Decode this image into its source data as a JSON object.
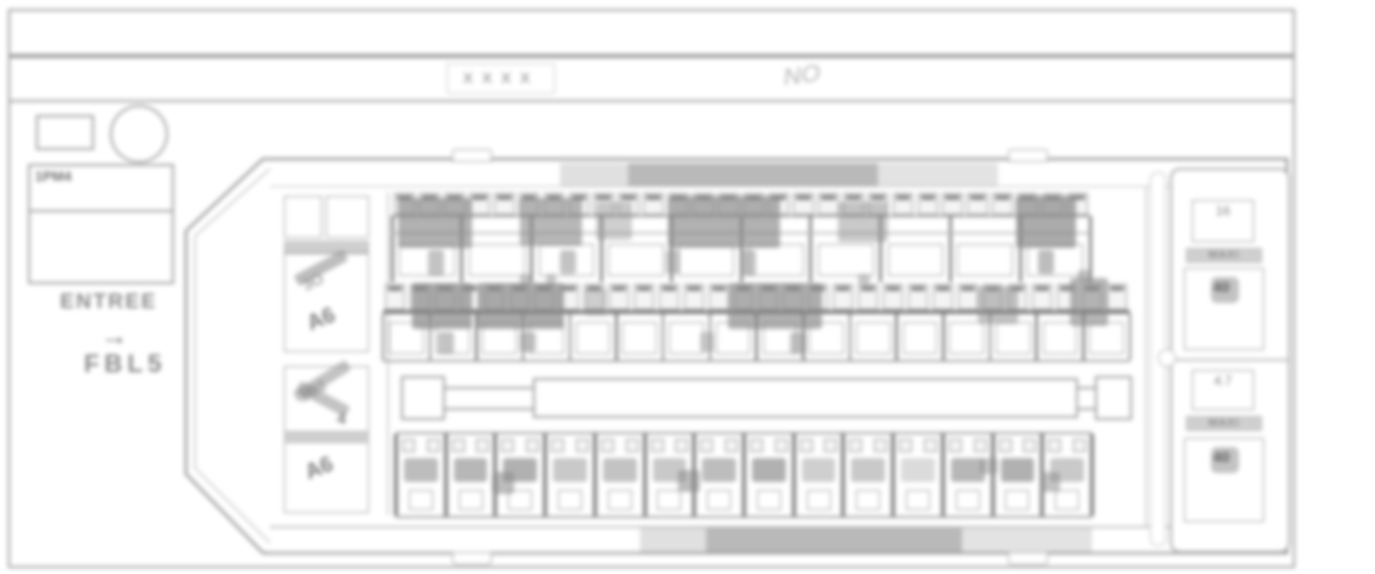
{
  "header": {
    "row1_text": "",
    "code_label": "XXXX",
    "approval_mark": "NO"
  },
  "left_panel": {
    "module_label": "1PM4",
    "entry_label": "ENTREE",
    "arrow_glyph": "→",
    "wire_label": "FBL5"
  },
  "relay_column": {
    "group1": {
      "band_text": "— —",
      "diag_text1": "3O",
      "tag": "A6"
    },
    "group2": {
      "band_text": "— —",
      "diag_text1": "1O2",
      "diag_text2": "4",
      "tag": "A6"
    }
  },
  "right_column": {
    "group1": {
      "value": "16",
      "type_label": "MAXI",
      "amp": "40"
    },
    "group2": {
      "value": "4.7",
      "type_label": "MAXI",
      "amp": "40"
    }
  },
  "figure": {
    "colors": {
      "stroke": "#9a9a9a",
      "dark_fill": "#b9b9b9",
      "light_fill": "#e0e0e0",
      "smudge": "#878787"
    },
    "top_row": {
      "x": 392,
      "w": 698,
      "strip_y": 193,
      "strip_h": 22,
      "cells": 28,
      "slots": 10,
      "slot_y": 216,
      "slot_h": 66,
      "smudges": [
        {
          "x": 398,
          "y": 198,
          "w": 74,
          "h": 50,
          "o": 0.65
        },
        {
          "x": 520,
          "y": 198,
          "w": 62,
          "h": 48,
          "o": 0.6
        },
        {
          "x": 596,
          "y": 202,
          "w": 36,
          "h": 38,
          "o": 0.4
        },
        {
          "x": 668,
          "y": 196,
          "w": 112,
          "h": 52,
          "o": 0.65
        },
        {
          "x": 838,
          "y": 202,
          "w": 50,
          "h": 40,
          "o": 0.45
        },
        {
          "x": 1016,
          "y": 196,
          "w": 60,
          "h": 52,
          "o": 0.7
        }
      ],
      "drips": [
        {
          "x": 428,
          "y": 250,
          "w": 16,
          "h": 26,
          "o": 0.5
        },
        {
          "x": 560,
          "y": 250,
          "w": 16,
          "h": 24,
          "o": 0.5
        },
        {
          "x": 666,
          "y": 250,
          "w": 14,
          "h": 24,
          "o": 0.45
        },
        {
          "x": 740,
          "y": 250,
          "w": 16,
          "h": 26,
          "o": 0.5
        },
        {
          "x": 1038,
          "y": 250,
          "w": 16,
          "h": 24,
          "o": 0.55
        }
      ]
    },
    "mid_row": {
      "x": 383,
      "w": 747,
      "strip_y": 284,
      "strip_h": 26,
      "cells": 30,
      "slots": 16,
      "slot_y": 314,
      "slot_h": 46,
      "smudges": [
        {
          "x": 412,
          "y": 283,
          "w": 60,
          "h": 46,
          "o": 0.7
        },
        {
          "x": 478,
          "y": 283,
          "w": 86,
          "h": 46,
          "o": 0.7
        },
        {
          "x": 585,
          "y": 288,
          "w": 22,
          "h": 28,
          "o": 0.35
        },
        {
          "x": 728,
          "y": 283,
          "w": 94,
          "h": 46,
          "o": 0.65
        },
        {
          "x": 978,
          "y": 286,
          "w": 40,
          "h": 38,
          "o": 0.5
        },
        {
          "x": 1070,
          "y": 278,
          "w": 38,
          "h": 48,
          "o": 0.6
        }
      ],
      "drips": [
        {
          "x": 438,
          "y": 332,
          "w": 16,
          "h": 22,
          "o": 0.5
        },
        {
          "x": 520,
          "y": 332,
          "w": 16,
          "h": 20,
          "o": 0.5
        },
        {
          "x": 700,
          "y": 332,
          "w": 14,
          "h": 20,
          "o": 0.4
        },
        {
          "x": 790,
          "y": 332,
          "w": 16,
          "h": 22,
          "o": 0.5
        }
      ],
      "ticks": [
        {
          "x": 520,
          "y": 274,
          "w": 12,
          "h": 10,
          "o": 0.5
        },
        {
          "x": 546,
          "y": 274,
          "w": 10,
          "h": 10,
          "o": 0.45
        },
        {
          "x": 858,
          "y": 274,
          "w": 12,
          "h": 10,
          "o": 0.45
        },
        {
          "x": 1078,
          "y": 270,
          "w": 14,
          "h": 12,
          "o": 0.5
        }
      ]
    },
    "bottom_row": {
      "x": 396,
      "w": 696,
      "y": 432,
      "h": 82,
      "slots": 14,
      "slot_opacities": [
        0.55,
        0.6,
        0.65,
        0.45,
        0.5,
        0.45,
        0.55,
        0.65,
        0.4,
        0.45,
        0.3,
        0.6,
        0.65,
        0.45
      ],
      "extra": [
        {
          "x": 492,
          "y": 470,
          "w": 22,
          "h": 22,
          "o": 0.55
        },
        {
          "x": 678,
          "y": 468,
          "w": 22,
          "h": 22,
          "o": 0.55
        },
        {
          "x": 980,
          "y": 456,
          "w": 18,
          "h": 16,
          "o": 0.45
        },
        {
          "x": 1040,
          "y": 470,
          "w": 20,
          "h": 20,
          "o": 0.5
        }
      ]
    }
  }
}
